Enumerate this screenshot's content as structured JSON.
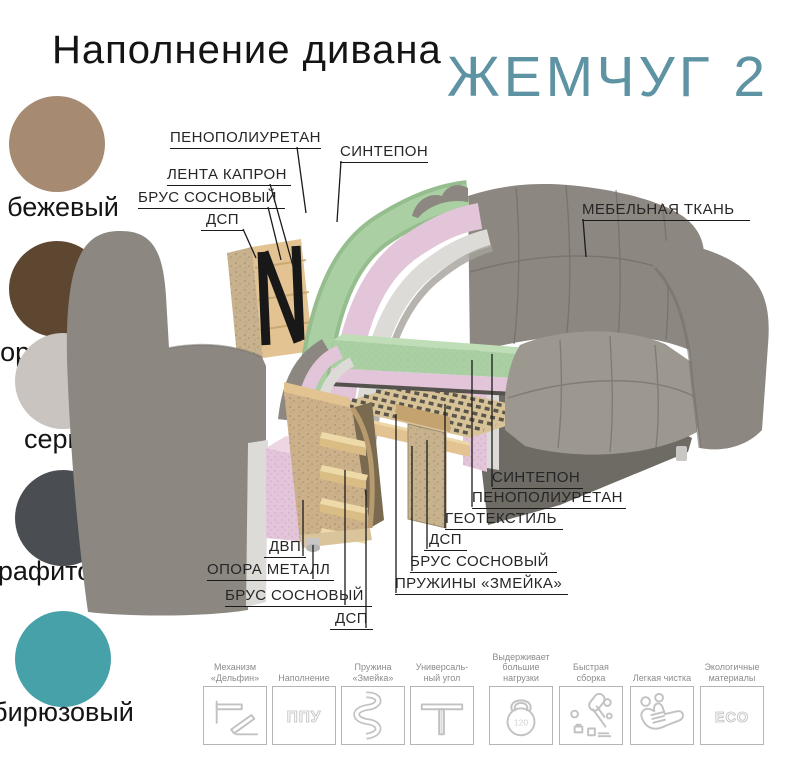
{
  "header": {
    "title": "Наполнение дивана",
    "product_name": "ЖЕМЧУГ 2"
  },
  "colors": {
    "accent": "#5E93A3",
    "label_gray": "#8C8C8C",
    "line": "#1B1B1B",
    "box_border": "#B5B5B5",
    "icon_gray": "#C2C2C2",
    "fabric": "#8C8780",
    "fabric_dark": "#6E6A64",
    "fabric_light": "#9C978F",
    "foam_green": "#A9CFA2",
    "foam_green_light": "#BFDDB6",
    "foam_pink": "#E3C5D9",
    "foam_pink_dark": "#D3AECB",
    "sintepon": "#DCDBD8",
    "wood": "#E2C391",
    "wood_dark": "#C5A36E",
    "dsp": "#C8B18D",
    "strap_black": "#181818",
    "metal": "#C8C7C5"
  },
  "swatches": [
    {
      "name": "бежевый",
      "color": "#A68B72"
    },
    {
      "name": "коричневый",
      "color": "#5E4731"
    },
    {
      "name": "серый",
      "color": "#C9C4BF"
    },
    {
      "name": "графитовый",
      "color": "#4A4E53"
    },
    {
      "name": "бирюзовый",
      "color": "#47A1A9"
    }
  ],
  "callouts": [
    {
      "text": "ПЕНОПОЛИУРЕТАН"
    },
    {
      "text": "СИНТЕПОН"
    },
    {
      "text": "ЛЕНТА КАПРОН"
    },
    {
      "text": "БРУС СОСНОВЫЙ"
    },
    {
      "text": "ДСП"
    },
    {
      "text": "МЕБЕЛЬНАЯ ТКАНЬ"
    },
    {
      "text": "СИНТЕПОН"
    },
    {
      "text": "ПЕНОПОЛИУРЕТАН"
    },
    {
      "text": "ГЕОТЕКСТИЛЬ"
    },
    {
      "text": "ДСП"
    },
    {
      "text": "БРУС СОСНОВЫЙ"
    },
    {
      "text": "ПРУЖИНЫ «ЗМЕЙКА»"
    },
    {
      "text": "ДВП"
    },
    {
      "text": "ОПОРА МЕТАЛЛ"
    },
    {
      "text": "БРУС СОСНОВЫЙ"
    },
    {
      "text": "ДСП"
    }
  ],
  "features": [
    {
      "label": "Механизм\n«Дельфин»"
    },
    {
      "label": "Наполнение"
    },
    {
      "label": "Пружина\n«Змейка»"
    },
    {
      "label": "Универсаль-\nный угол"
    },
    {
      "label": "Выдерживает\nбольшие\nнагрузки"
    },
    {
      "label": "Быстрая\nсборка"
    },
    {
      "label": "Легкая чистка"
    },
    {
      "label": "Экологичные\nматериалы"
    }
  ],
  "icon_texts": {
    "filling": "ППУ",
    "load": "120",
    "eco": "ECO"
  }
}
